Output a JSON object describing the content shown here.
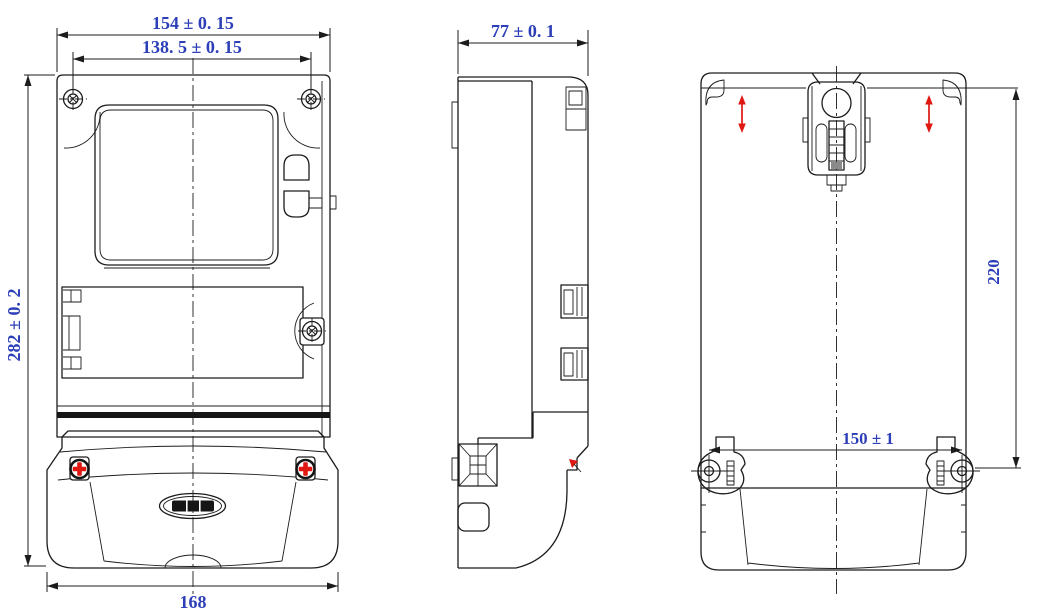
{
  "drawing": {
    "type": "engineering-outline-drawing",
    "views": {
      "front": {
        "dimensions": {
          "overall_width": "154 ± 0. 15",
          "fixing_screw_span": "138. 5 ± 0. 15",
          "overall_height": "282 ± 0. 2",
          "terminal_cover_width": "168"
        }
      },
      "side": {
        "dimensions": {
          "overall_depth": "77 ± 0. 1"
        }
      },
      "back": {
        "dimensions": {
          "hanger_to_mounting_feet": "220",
          "mounting_feet_span": "150 ± 1"
        }
      }
    },
    "colors": {
      "line": "#1c1c1c",
      "dimension_text": "#2c3fb8",
      "seal_accent_red": "#e01812",
      "background": "#ffffff"
    },
    "icons": {
      "brand_logo": "oval-wordmark-logo-icon",
      "seal_screw": "red-cross-seal-screw-icon",
      "corner_screw": "phillips-screw-icon",
      "latch_screw": "phillips-screw-icon",
      "hanger_adjustment": "red-double-arrow-icon",
      "seal_wire": "black-arrow-flag-icon"
    }
  }
}
